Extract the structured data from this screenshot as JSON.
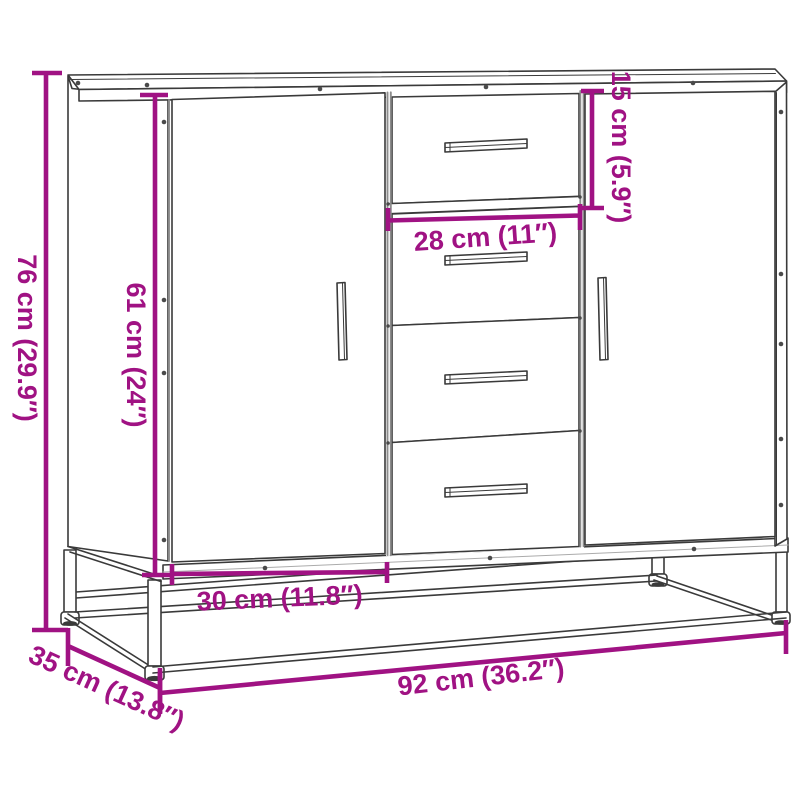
{
  "diagram": {
    "product": "Sideboard with two doors and four drawers on a metal base frame",
    "view": "front three-quarter line drawing with dimension callouts",
    "colors": {
      "dimension_accent": "#A01283",
      "drawing_outline": "#3A3A3A",
      "divider_gray": "#8C8C8C",
      "background": "#FFFFFF"
    },
    "dimensions": {
      "overall_height": "76 cm (29.9″)",
      "inner_height": "61 cm (24″)",
      "top_drawer_height": "15 cm (5.9″)",
      "drawer_width": "28 cm (11″)",
      "door_width": "30 cm (11.8″)",
      "depth": "35 cm (13.8″)",
      "overall_width": "92 cm (36.2″)"
    }
  }
}
